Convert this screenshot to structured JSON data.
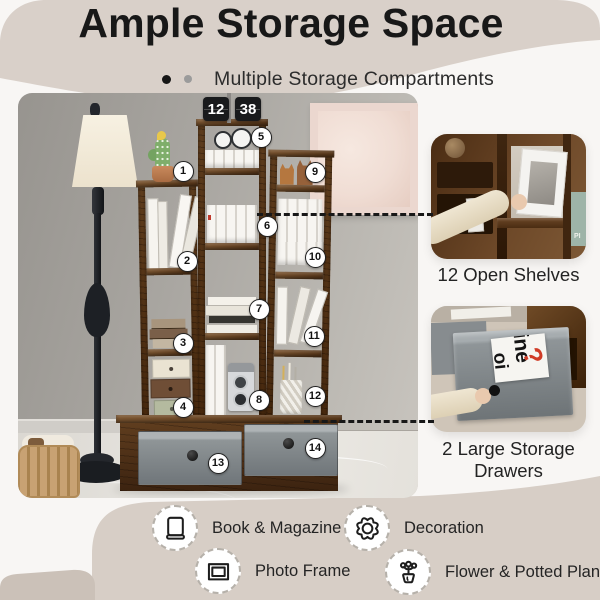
{
  "header": {
    "title": "Ample Storage Space",
    "subtitle": "Multiple Storage Compartments"
  },
  "photo": {
    "clock": {
      "hours": "12",
      "minutes": "38"
    }
  },
  "markers": [
    {
      "label": "1",
      "x": 183,
      "y": 171
    },
    {
      "label": "2",
      "x": 187,
      "y": 261
    },
    {
      "label": "3",
      "x": 183,
      "y": 343
    },
    {
      "label": "4",
      "x": 183,
      "y": 407
    },
    {
      "label": "5",
      "x": 261,
      "y": 137
    },
    {
      "label": "6",
      "x": 267,
      "y": 226
    },
    {
      "label": "7",
      "x": 259,
      "y": 309
    },
    {
      "label": "8",
      "x": 259,
      "y": 400
    },
    {
      "label": "9",
      "x": 315,
      "y": 172
    },
    {
      "label": "10",
      "x": 315,
      "y": 257
    },
    {
      "label": "11",
      "x": 314,
      "y": 336
    },
    {
      "label": "12",
      "x": 315,
      "y": 396
    },
    {
      "label": "13",
      "x": 218,
      "y": 463
    },
    {
      "label": "14",
      "x": 315,
      "y": 448
    }
  ],
  "callouts": {
    "open_shelves": {
      "label": "12 Open Shelves",
      "spine_text": "PI"
    },
    "drawers": {
      "label": "2 Large Storage Drawers",
      "magazine": {
        "word1": "ine",
        "word2": "oi",
        "punct": "?"
      }
    }
  },
  "legend": [
    {
      "icon": "book-icon",
      "label": "Book & Magazine"
    },
    {
      "icon": "decoration-icon",
      "label": "Decoration"
    },
    {
      "icon": "photo-frame-icon",
      "label": "Photo Frame"
    },
    {
      "icon": "plant-icon",
      "label": "Flower & Potted Plant"
    }
  ],
  "colors": {
    "header_bg": "#d9d0c9",
    "band_bg": "#d7cec6",
    "band_corner": "#cbc1b8",
    "wood": "#5a3820",
    "drawer_gray": "#8f9597",
    "marker_bg": "#ffffff",
    "question_red": "#d03b26",
    "teal_book": "#9eb4a8"
  }
}
